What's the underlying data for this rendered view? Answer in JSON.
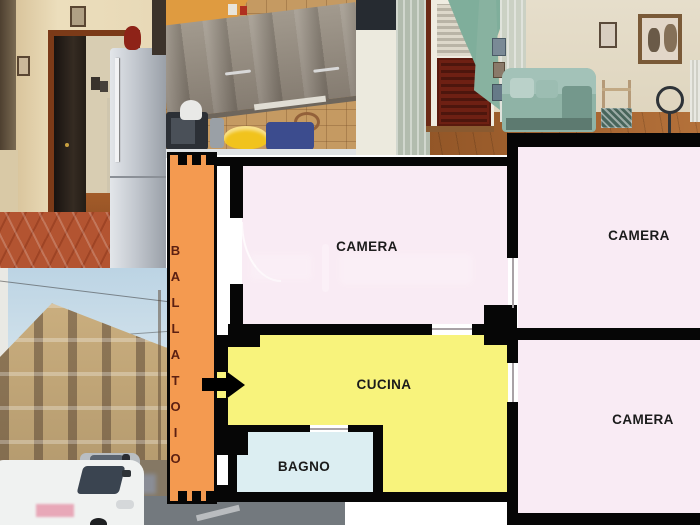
{
  "floorplan": {
    "rooms": {
      "camera_top": {
        "label": "CAMERA",
        "fill": "#F9EBF4"
      },
      "camera_right_top": {
        "label": "CAMERA",
        "fill": "#F9EBF4"
      },
      "camera_right_bottom": {
        "label": "CAMERA",
        "fill": "#F9EBF4"
      },
      "cucina": {
        "label": "CUCINA",
        "fill": "#F8F37C"
      },
      "bagno": {
        "label": "BAGNO",
        "fill": "#DCEEF2"
      },
      "ballatoio": {
        "label": "BALLATOIO",
        "fill": "#F49A50",
        "letter_color": "#5C2012"
      }
    },
    "wall_color": "#060606",
    "label_color": "#1B1B1B",
    "entrance_arrow": {
      "direction": "right",
      "color": "#000000"
    },
    "door_opening_color": "#FFFFFF"
  },
  "photos": [
    {
      "position": "top-left",
      "subject": "hallway with refrigerator and terracotta floor"
    },
    {
      "position": "top-center",
      "subject": "kitchen with wood cabinets"
    },
    {
      "position": "top-right",
      "subject": "living room with sofa and balcony door"
    },
    {
      "position": "bottom-left",
      "subject": "apartment building exterior with white van"
    }
  ],
  "watermark": {
    "present": true,
    "legible": false
  }
}
